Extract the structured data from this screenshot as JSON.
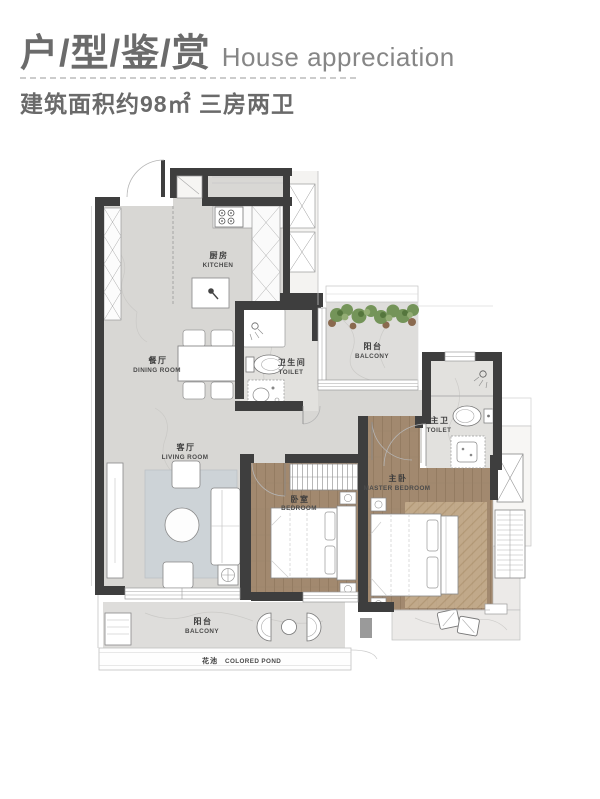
{
  "header": {
    "title_cn": "户/型/鉴/赏",
    "title_en": "House appreciation",
    "subtitle": "建筑面积约98㎡ 三房两卫"
  },
  "floor_plan": {
    "rooms": {
      "kitchen": {
        "cn": "厨房",
        "en": "KITCHEN"
      },
      "dining_room": {
        "cn": "餐厅",
        "en": "DINING ROOM"
      },
      "toilet": {
        "cn": "卫生间",
        "en": "TOILET"
      },
      "balcony_top": {
        "cn": "阳台",
        "en": "BALCONY"
      },
      "living_room": {
        "cn": "客厅",
        "en": "LIVING ROOM"
      },
      "master_toilet": {
        "cn": "主卫",
        "en": "TOILET"
      },
      "bedroom": {
        "cn": "卧室",
        "en": "BEDROOM"
      },
      "master_bedroom": {
        "cn": "主卧",
        "en": "MASTER BEDROOM"
      },
      "balcony_bottom": {
        "cn": "阳台",
        "en": "BALCONY"
      },
      "pond": {
        "cn": "花池",
        "en": "COLORED POND"
      }
    }
  },
  "colors": {
    "heading_text": "#6b6b6b",
    "heading_en_text": "#868686",
    "wall": "#3e3e3e",
    "floor_common": "#d8d7d4",
    "floor_toilet": "#e2e1de",
    "floor_balcony": "#dedddb",
    "wood_floor": "#a2896f",
    "living_rug": "#cdd3d7",
    "plant_green": "#6f9153"
  }
}
